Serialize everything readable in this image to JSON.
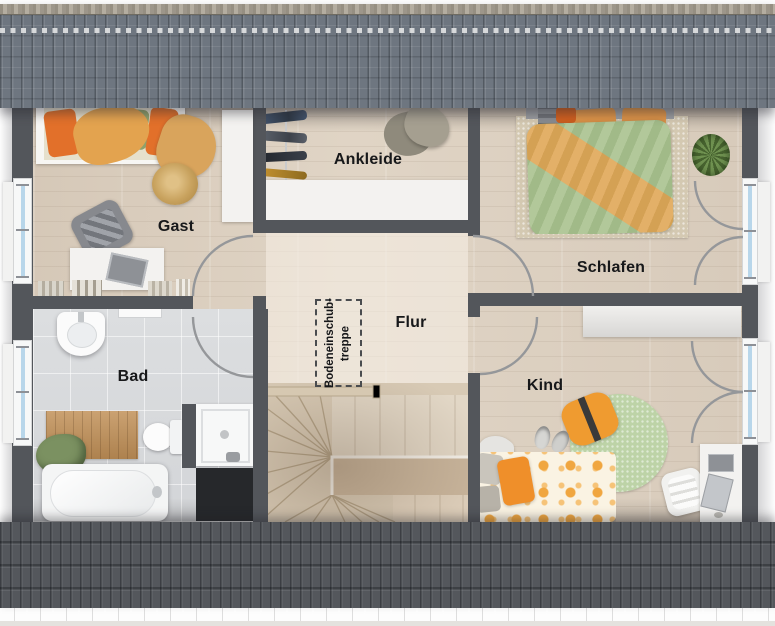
{
  "rooms": [
    {
      "id": "gast",
      "label": "Gast"
    },
    {
      "id": "ankleide",
      "label": "Ankleide"
    },
    {
      "id": "schlafen",
      "label": "Schlafen"
    },
    {
      "id": "flur",
      "label": "Flur"
    },
    {
      "id": "bad",
      "label": "Bad"
    },
    {
      "id": "kind",
      "label": "Kind"
    }
  ],
  "annotations": {
    "attic_hatch": {
      "label": "Bodeneinschub-\ntreppe"
    }
  },
  "palette": {
    "roof_top": "#6e7680",
    "roof_bottom": "#54575c",
    "wall": "#53565b",
    "wood_floor": "#dcd0c1",
    "hall_floor": "#efe6d8",
    "tile_floor": "#d8dadc",
    "stair_wood": "#d8cab5",
    "window_glass": "#b8d6ea",
    "duvet_green": "#a9c28f",
    "accent_orange": "#e8963f",
    "rug_green": "#bdd3a7",
    "label_text": "#17181a"
  }
}
